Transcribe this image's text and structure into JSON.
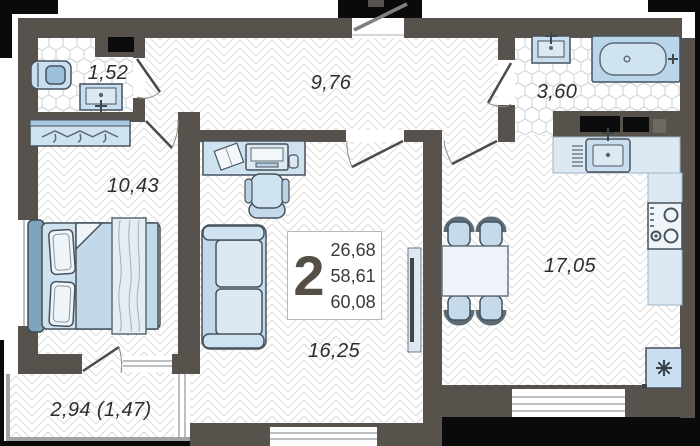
{
  "plan": {
    "unit": {
      "rooms_count": "2",
      "stats": [
        "26,68",
        "58,61",
        "60,08"
      ]
    },
    "rooms": [
      {
        "id": "laundry-bathroom",
        "area": "1,52"
      },
      {
        "id": "hallway",
        "area": "9,76"
      },
      {
        "id": "bathroom",
        "area": "3,60"
      },
      {
        "id": "bedroom",
        "area": "10,43"
      },
      {
        "id": "kitchen",
        "area": "17,05"
      },
      {
        "id": "living-room",
        "area": "16,25"
      },
      {
        "id": "balcony",
        "area": "2,94 (1,47)"
      }
    ],
    "colors": {
      "wall": "#57534c",
      "shadow": "#0a0a0a",
      "furniture": "#c9def0",
      "furniture_light": "#dce9f3",
      "outline": "#47525c"
    }
  }
}
